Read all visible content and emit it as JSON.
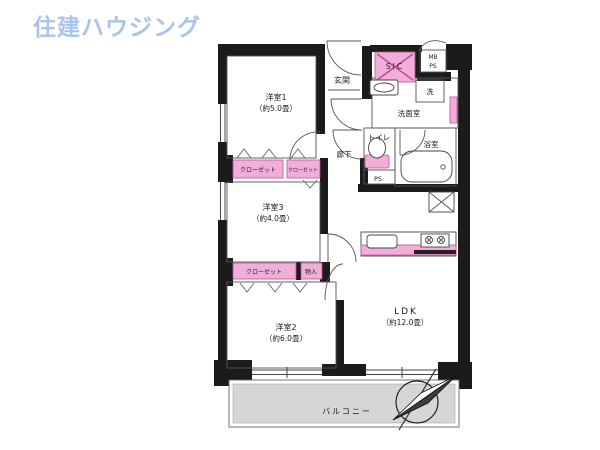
{
  "logo": {
    "text": "住建ハウジング",
    "color": "#a9c3ee"
  },
  "rooms": {
    "yoshitsu1": {
      "name": "洋室1",
      "size": "（約5.0畳）"
    },
    "yoshitsu3": {
      "name": "洋室3",
      "size": "（約4.0畳）"
    },
    "yoshitsu2": {
      "name": "洋室2",
      "size": "（約6.0畳）"
    },
    "ldk": {
      "name": "LDK",
      "size": "（約12.0畳）"
    }
  },
  "labels": {
    "genkan": "玄関",
    "sic": "SIC",
    "mb": "MB",
    "ps_meter": "PS",
    "laundry": "洗",
    "senmen": "洗面室",
    "toilet": "トイレ",
    "ps_shaft": "PS",
    "rouka": "廊下",
    "bath": "浴室",
    "closet1": "クローゼット",
    "closet2": "クローゼット",
    "closet3": "クローゼット",
    "mononyu": "物入",
    "balcony": "バルコニー"
  },
  "colors": {
    "wall": "#1b1b1b",
    "accent_pink": "#f0aed8",
    "accent_pink_dark": "#c24f9e",
    "balcony_gray": "#d6d6d6",
    "logo_blue": "#a9c3ee"
  }
}
